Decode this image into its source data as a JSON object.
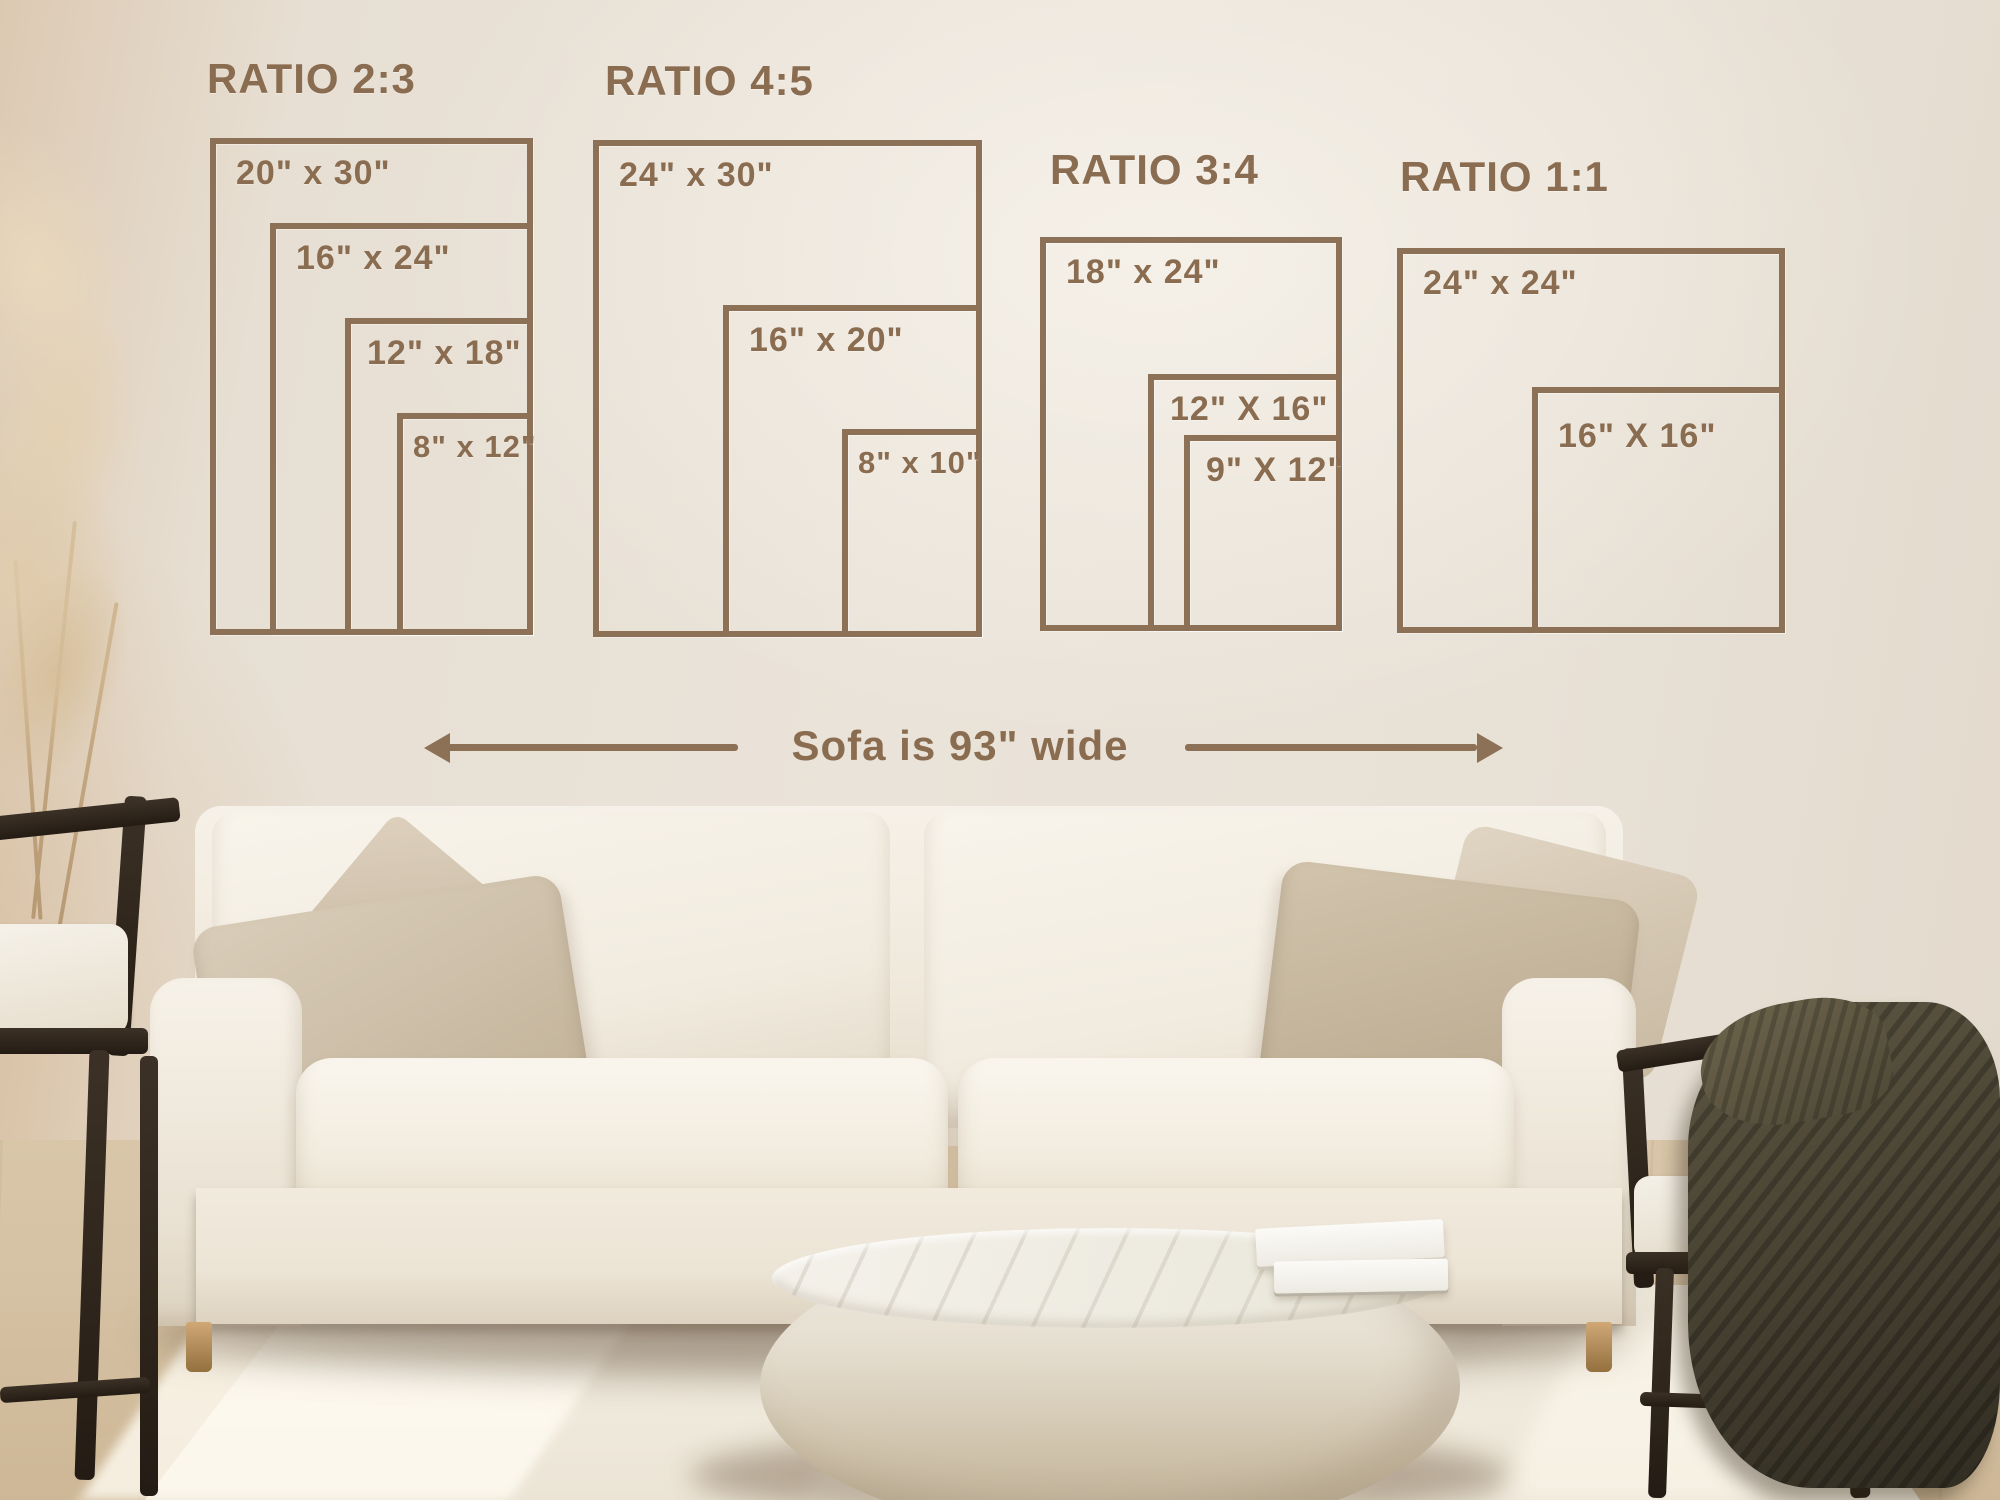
{
  "diagram": {
    "line_color": "#8c7156",
    "text_color": "#8a6c50",
    "sofa_width_label": "Sofa is 93\" wide",
    "groups": [
      {
        "title": "RATIO 2:3",
        "sizes": [
          {
            "label": "20\" x 30\""
          },
          {
            "label": "16\" x 24\""
          },
          {
            "label": "12\" x 18\""
          },
          {
            "label": "8\" x 12\""
          }
        ]
      },
      {
        "title": "RATIO 4:5",
        "sizes": [
          {
            "label": "24\" x 30\""
          },
          {
            "label": "16\" x 20\""
          },
          {
            "label": "8\" x 10\""
          }
        ]
      },
      {
        "title": "RATIO 3:4",
        "sizes": [
          {
            "label": "18\" x 24\""
          },
          {
            "label": "12\" X 16\""
          },
          {
            "label": "9\" X 12\""
          }
        ]
      },
      {
        "title": "RATIO 1:1",
        "sizes": [
          {
            "label": "24\" x 24\""
          },
          {
            "label": "16\" X 16\""
          }
        ]
      }
    ]
  },
  "scene": {
    "wall_color": "#e9e2d8",
    "sofa_color": "#f2ecdf",
    "pillow_color": "#cbbca4",
    "rug_color": "#ece6d9",
    "table_color": "#ece7dc",
    "blanket_color": "#4a4434",
    "chair_wood_color": "#30271e"
  }
}
